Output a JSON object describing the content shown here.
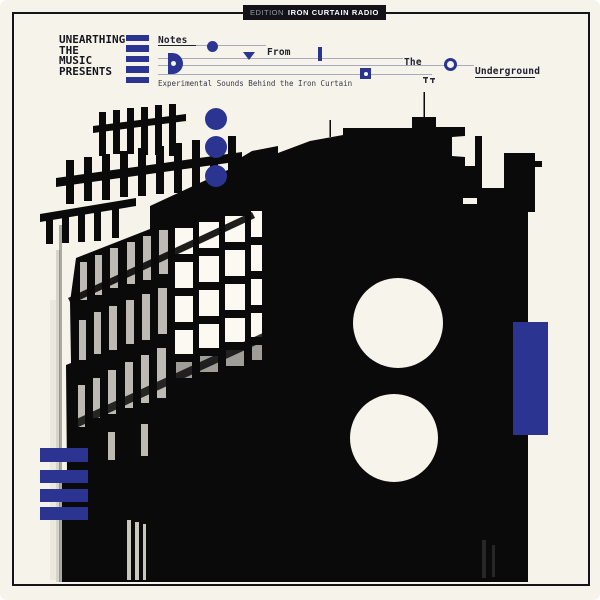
{
  "badge": {
    "prefix": "EDITION",
    "label": "IRON CURTAIN RADIO"
  },
  "presenter": {
    "line1": "UNEARTHING",
    "line2": "THE",
    "line3": "MUSIC",
    "line4": "PRESENTS"
  },
  "title": {
    "word1": "Notes",
    "word2": "From",
    "word3": "The",
    "word4": "Underground"
  },
  "tagline": "Experimental Sounds Behind the Iron Curtain",
  "colors": {
    "accent_blue": "#2b3591",
    "background_cream": "#f6f3ea",
    "ink": "#16161e",
    "staff_line": "#a8abbe",
    "badge_bg": "#121218",
    "photo_black": "#0a0a0a"
  }
}
